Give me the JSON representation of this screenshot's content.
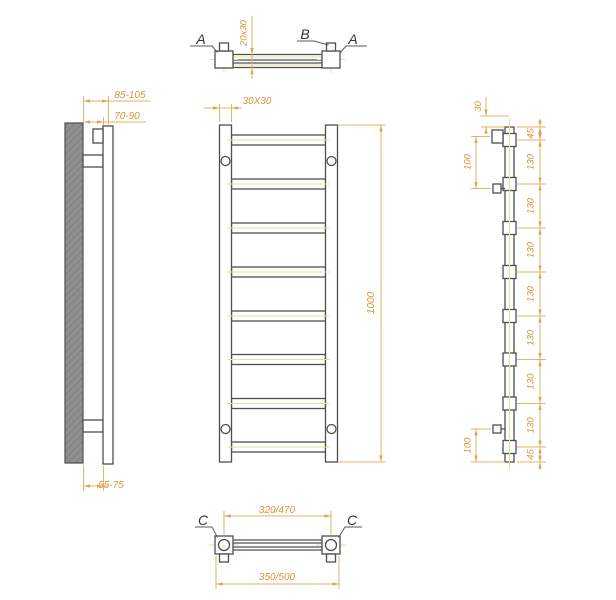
{
  "drawing": {
    "top_view": {
      "label_a_left": "A",
      "label_b": "B",
      "label_a_right": "A",
      "dim_profile": "20x30"
    },
    "left_view": {
      "dim_wall_to_face": "85-105",
      "dim_wall_to_tube": "70-90",
      "dim_wall_to_bottom": "55-75"
    },
    "front_view": {
      "dim_rail_profile": "30X30",
      "dim_height": "1000"
    },
    "right_view": {
      "dim_top": "30",
      "dim_bracket_top": "100",
      "dim_bracket_bottom": "100",
      "dim_end_top": "45",
      "dim_end_bottom": "45",
      "dim_rung_spacing": "130"
    },
    "bottom_view": {
      "label_c_left": "C",
      "label_c_right": "C",
      "dim_mount_centers": "320/470",
      "dim_overall_width": "350/500"
    }
  },
  "colors": {
    "outline": "#4f4f4f",
    "dimension_line": "#EAB266",
    "dimension_text": "#D8943C",
    "centerline": "#E7DF9E",
    "wall_fill": "#8f8f8f",
    "background": "#ffffff"
  }
}
